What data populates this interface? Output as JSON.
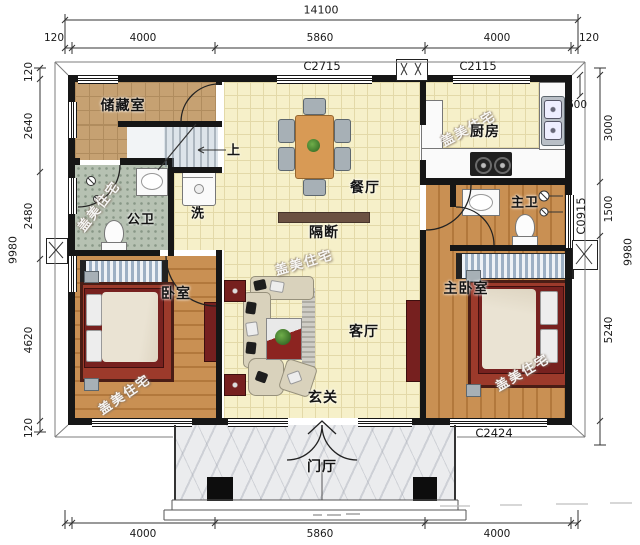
{
  "watermark": "盖美住宅",
  "dims": {
    "top_total": "14100",
    "top": [
      "120",
      "4000",
      "5860",
      "4000",
      "120"
    ],
    "bottom": [
      "4000",
      "5860",
      "4000"
    ],
    "left": [
      "120",
      "2640",
      "2480",
      "4620",
      "120"
    ],
    "left_total": "9980",
    "right": [
      "600",
      "3000",
      "1500",
      "5240"
    ],
    "right_total": "9980"
  },
  "window_codes": {
    "top_left": "C2715",
    "top_right": "C2115",
    "right": "C0915",
    "bottom": "C2424"
  },
  "rooms": {
    "storage": "储藏室",
    "public_bath": "公卫",
    "wash": "洗",
    "up": "上",
    "dining": "餐厅",
    "partition": "隔断",
    "kitchen": "厨房",
    "master_bath": "主卫",
    "bedroom": "卧室",
    "living": "客厅",
    "entry": "玄关",
    "master_bedroom": "主卧室",
    "porch": "门厅"
  }
}
